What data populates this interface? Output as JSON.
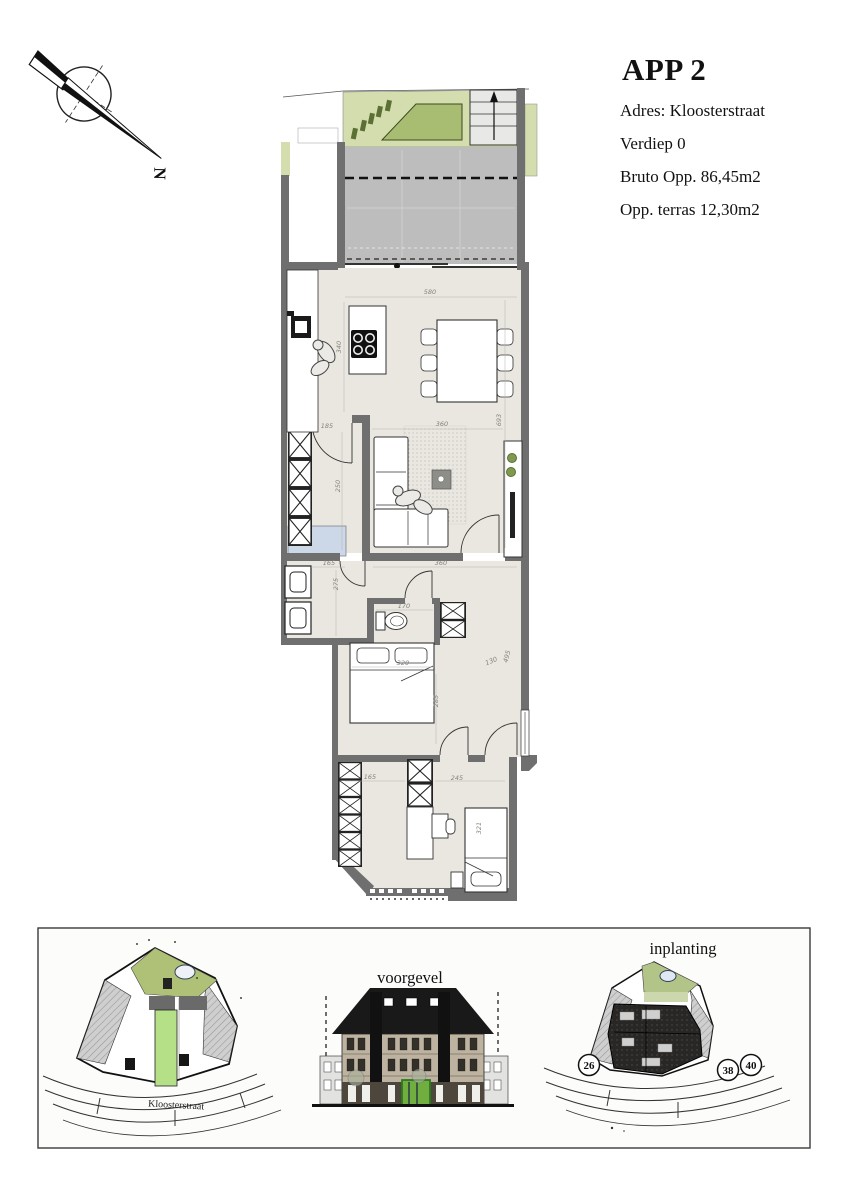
{
  "title_block": {
    "title": "APP 2",
    "address": "Adres: Kloosterstraat",
    "floor": "Verdiep 0",
    "gross_area": "Bruto Opp. 86,45m2",
    "terrace_area": "Opp. terras 12,30m2"
  },
  "compass": {
    "north_label": "N"
  },
  "floor_plan": {
    "dims": {
      "living_width": "580",
      "kitchen_island_depth": "340",
      "living_length": "693",
      "lounge_width": "360",
      "storage_door": "185",
      "storage_depth": "250",
      "laundry_width": "165",
      "laundry_depth": "275",
      "hall_width": "360",
      "wc_width": "170",
      "bed1_width": "320",
      "bed1_depth": "285",
      "hall_a": "130",
      "hall_b": "495",
      "dressing_width": "165",
      "bedroom2_width": "245",
      "bed2_length": "321"
    }
  },
  "insets": {
    "left_siteplan": {
      "street_label": "Kloosterstraat"
    },
    "facade": {
      "label": "voorgevel"
    },
    "right_siteplan": {
      "label": "inplanting",
      "house_numbers": [
        "26",
        "38",
        "40"
      ]
    }
  },
  "colors": {
    "wall": "#6f6f6f",
    "floor": "#eae7e1",
    "terrace": "#bdbdbd",
    "garden_light": "#d4ddae",
    "garden_dark": "#a9bd72",
    "water": "#ccd7e8",
    "unit_highlight": "#b6e088",
    "facade_green": "#6fae3f"
  }
}
